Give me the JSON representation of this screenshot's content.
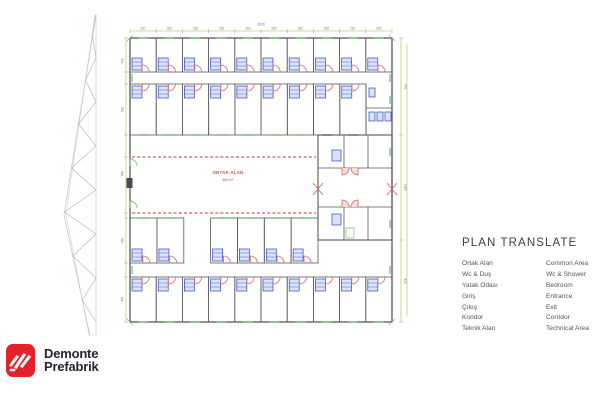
{
  "legend": {
    "title": "PLAN TRANSLATE",
    "rows": [
      {
        "tr": "Ortak Alan",
        "en": "Common Area"
      },
      {
        "tr": "Wc & Duş",
        "en": "Wc & Shower"
      },
      {
        "tr": "Yatak Odası",
        "en": "Bedroom"
      },
      {
        "tr": "Giriş",
        "en": "Entrance"
      },
      {
        "tr": "Çıkış",
        "en": "Exit"
      },
      {
        "tr": "Koridor",
        "en": "Corridor"
      },
      {
        "tr": "Teknik Alan",
        "en": "Technical Area"
      }
    ]
  },
  "logo": {
    "line1": "Demonte",
    "line2": "Prefabrik",
    "brand_red": "#e32229",
    "text_color": "#262531"
  },
  "floor_plan": {
    "common_area_label": "ORTAK ALAN",
    "common_area_size": "480 m²",
    "top_total": "2620",
    "top_dim_labels": [
      "262",
      "262",
      "262",
      "262",
      "262",
      "262",
      "262",
      "262",
      "262",
      "262"
    ],
    "left_dim_labels": [
      "340",
      "510",
      "780",
      "450",
      "450"
    ],
    "right_dim_labels": [
      "970",
      "1050",
      "820"
    ],
    "colors": {
      "wall": "#585858",
      "door": "#d96868",
      "pod": "#2b46c8",
      "pod_fill": "#dbe3f8",
      "window": "#7cc47c",
      "dashed": "#c23a3a",
      "dim": "#c9cf6a",
      "dim_text": "#777777",
      "label": "#c0504d",
      "truss": "#a7c2c2",
      "truss_accent": "#ecc9c9"
    },
    "outer": {
      "x": 130,
      "y": 38,
      "w": 262,
      "h": 284
    },
    "rows": [
      {
        "y": 38,
        "h": 34,
        "x0": 130,
        "x1": 392,
        "count": 10,
        "door": "bottom",
        "window": "top",
        "gaps": []
      },
      {
        "y": 84,
        "h": 51,
        "x0": 130,
        "x1": 366,
        "count": 9,
        "door": "top",
        "window": "bottom",
        "gaps": []
      },
      {
        "y": 218,
        "h": 45,
        "x0": 130,
        "x1": 318,
        "count": 7,
        "door": "bottom",
        "window": "top",
        "gaps": [
          2
        ]
      },
      {
        "y": 277,
        "h": 45,
        "x0": 130,
        "x1": 392,
        "count": 10,
        "door": "top",
        "window": "bottom",
        "gaps": []
      }
    ],
    "center_block": {
      "x": 318,
      "y": 135,
      "w": 74,
      "h": 105
    },
    "dashed_lines": {
      "x0": 132,
      "x1": 316,
      "y1": 157,
      "y2": 213
    }
  }
}
